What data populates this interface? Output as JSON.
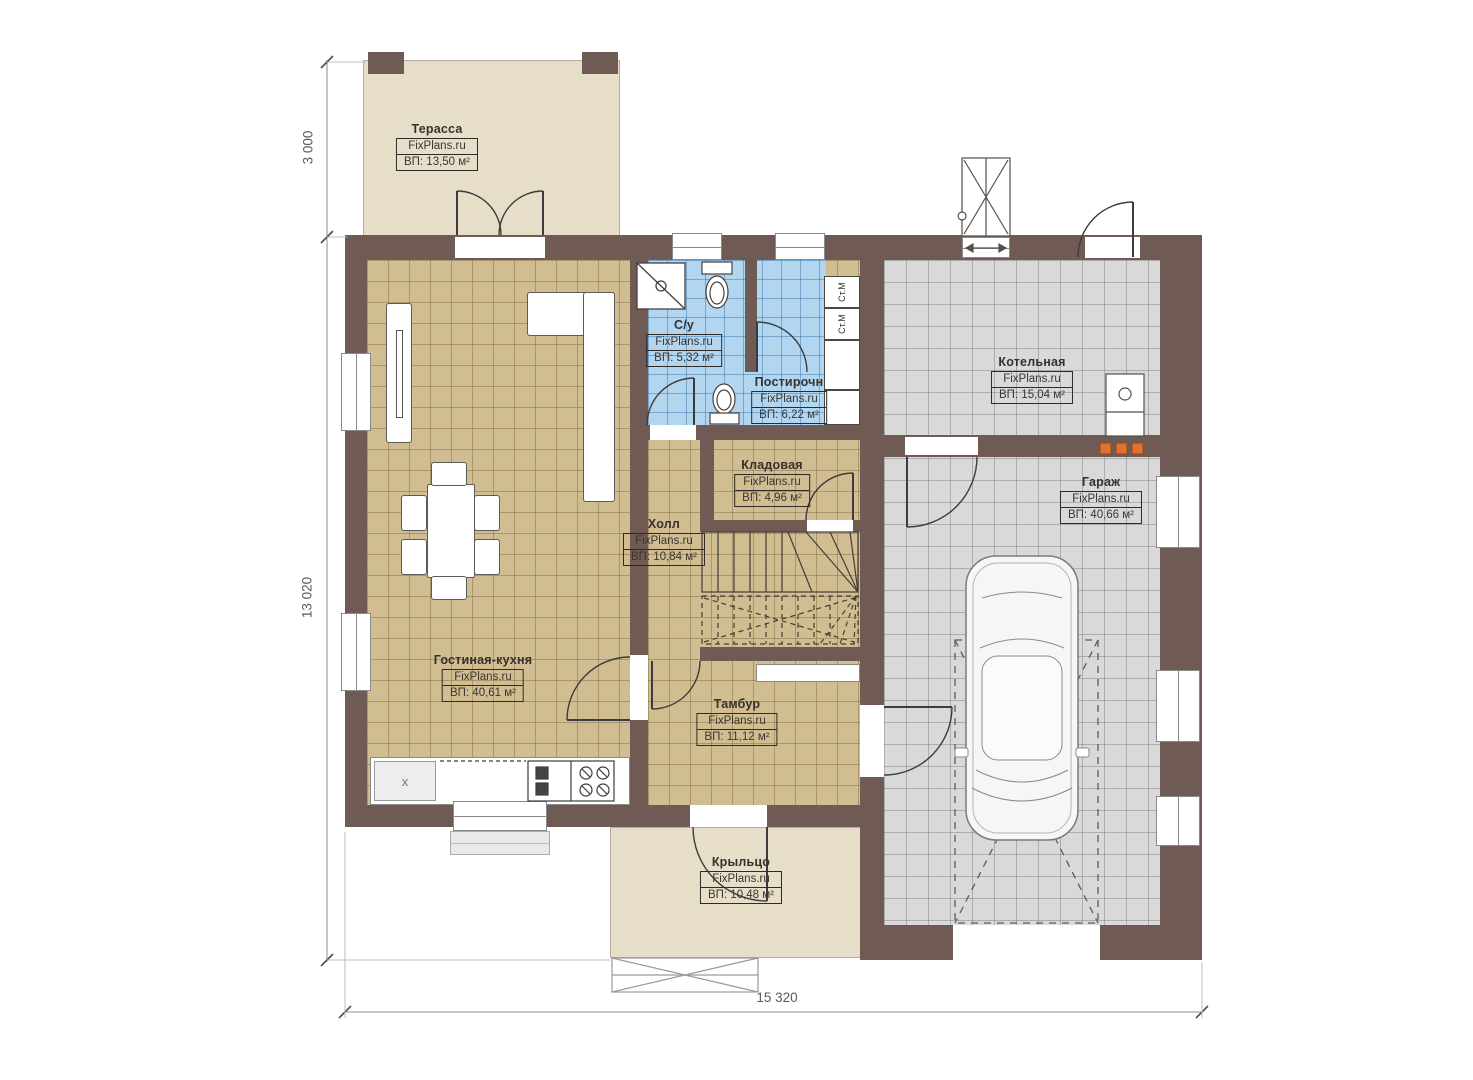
{
  "brand": "FixPlans.ru",
  "dimensions": {
    "terrace_depth": "3 000",
    "house_depth": "13 020",
    "house_width": "15 320"
  },
  "appliances": {
    "washer": "Ст.М",
    "dryer": "Ст.М"
  },
  "kitchen": {
    "sink_mark": "x"
  },
  "rooms": [
    {
      "id": "terrace",
      "name": "Терасса",
      "area": "ВП: 13,50 м²"
    },
    {
      "id": "bathroom",
      "name": "С/у",
      "area": "ВП: 5,32 м²"
    },
    {
      "id": "laundry",
      "name": "Постирочн",
      "area": "ВП: 6,22 м²"
    },
    {
      "id": "boiler",
      "name": "Котельная",
      "area": "ВП: 15,04 м²"
    },
    {
      "id": "storage",
      "name": "Кладовая",
      "area": "ВП: 4,96 м²"
    },
    {
      "id": "hall",
      "name": "Холл",
      "area": "ВП: 10,84 м²"
    },
    {
      "id": "garage",
      "name": "Гараж",
      "area": "ВП: 40,66 м²"
    },
    {
      "id": "living",
      "name": "Гостиная-кухня",
      "area": "ВП: 40,61 м²"
    },
    {
      "id": "vestibule",
      "name": "Тамбур",
      "area": "ВП: 11,12 м²"
    },
    {
      "id": "porch",
      "name": "Крыльцо",
      "area": "ВП: 10,48 м²"
    }
  ],
  "colors": {
    "wall": "#6f5b54",
    "floor_wood": "#d1bd92",
    "floor_wet": "#b3d6f0",
    "floor_garage": "#d9d9d9",
    "deck": "#e7dec9",
    "accent_orange": "#e0712c"
  }
}
